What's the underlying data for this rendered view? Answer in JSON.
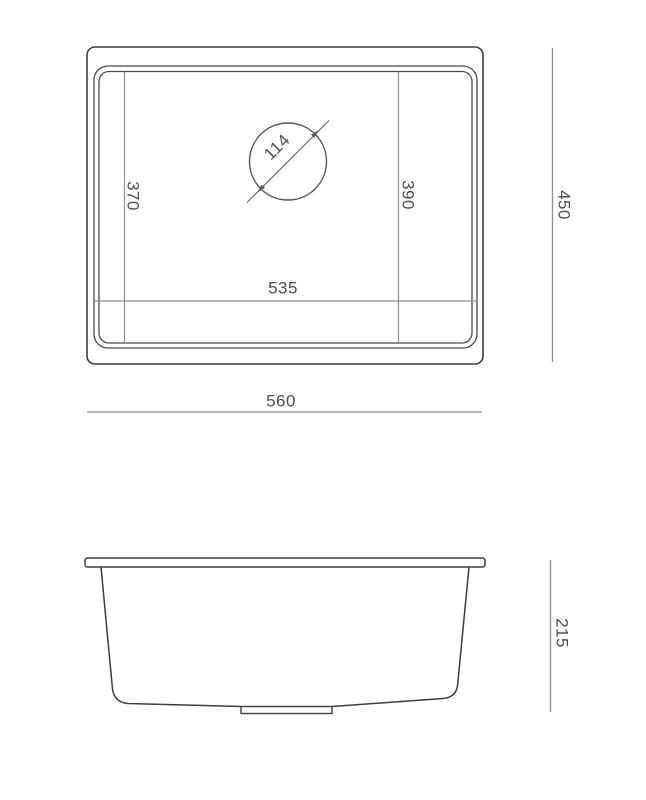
{
  "diagram": {
    "type": "technical-drawing",
    "subject": "undermount-sink-dimensions",
    "colors": {
      "background": "#ffffff",
      "outline": "#3d3d3d",
      "dimension_line": "#8f8f8f",
      "text": "#4f4f4f"
    },
    "top_view": {
      "labels": {
        "overall_width": "560",
        "overall_depth": "450",
        "bowl_width": "535",
        "bowl_depth_left": "370",
        "bowl_depth_right": "390",
        "drain_diameter": "114"
      }
    },
    "side_view": {
      "labels": {
        "overall_height": "215"
      }
    }
  }
}
